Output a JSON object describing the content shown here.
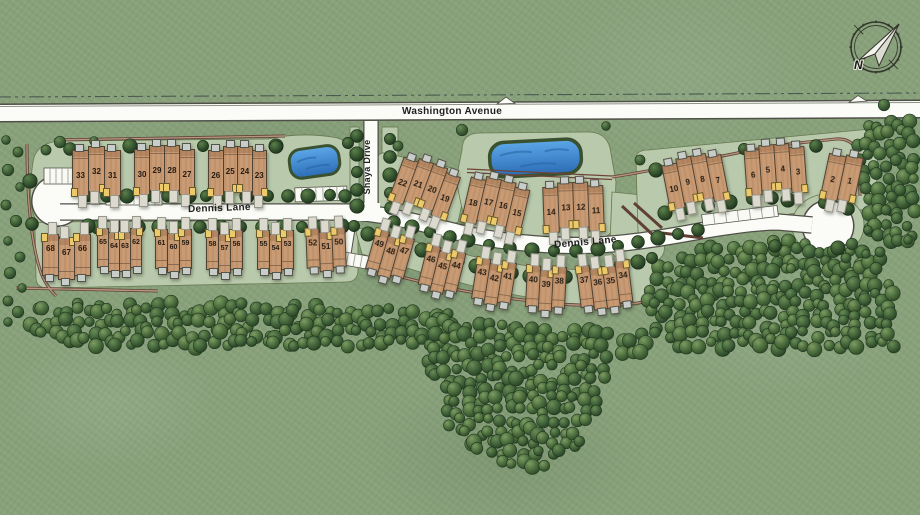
{
  "map": {
    "title": "community site plan",
    "streets": {
      "washington_avenue": "Washington Avenue",
      "dennis_lane_west": "Dennis Lane",
      "dennis_lane_east": "Dennis Lane",
      "shaya_drive": "Shaya Drive"
    },
    "compass": {
      "north_label": "N"
    },
    "colors": {
      "grass": "#8ba47e",
      "road": "#fbfcf7",
      "road_casing": "#4f5047",
      "pad": "#b9c9ab",
      "pad_border": "#66784f",
      "house": "#c89b75",
      "house_border": "#4e4232",
      "pond": "#3f87d2",
      "tree": "#3c5c33",
      "trail": "#6f4336",
      "porch": "#ecc96b",
      "deck": "#c9cdc9",
      "driveway": "#dcdacf",
      "lot_number_ink": "#241a10",
      "label_ink": "#1f1f1f"
    },
    "lot_groups": [
      {
        "lots": [
          "33",
          "32",
          "31"
        ],
        "row": "north",
        "x": 72,
        "y": 150,
        "uw": 17,
        "uh": 46,
        "rot": 0
      },
      {
        "lots": [
          "30",
          "29",
          "28",
          "27"
        ],
        "row": "north",
        "x": 134,
        "y": 149,
        "uw": 16,
        "uh": 46,
        "rot": 0
      },
      {
        "lots": [
          "26",
          "25",
          "24",
          "23"
        ],
        "row": "north",
        "x": 208,
        "y": 150,
        "uw": 15.5,
        "uh": 46,
        "rot": 0
      },
      {
        "lots": [
          "22",
          "21",
          "20",
          "19"
        ],
        "row": "north",
        "x": 394,
        "y": 166,
        "uw": 16,
        "uh": 46,
        "rot": 20
      },
      {
        "lots": [
          "18",
          "17",
          "16",
          "15"
        ],
        "row": "north",
        "x": 465,
        "y": 183,
        "uw": 16,
        "uh": 46,
        "rot": 13
      },
      {
        "lots": [
          "14",
          "13",
          "12",
          "11"
        ],
        "row": "north",
        "x": 543,
        "y": 186,
        "uw": 16,
        "uh": 46,
        "rot": -2
      },
      {
        "lots": [
          "10",
          "9",
          "8",
          "7"
        ],
        "row": "north",
        "x": 665,
        "y": 159,
        "uw": 16,
        "uh": 46,
        "rot": -11
      },
      {
        "lots": [
          "6",
          "5",
          "4",
          "3"
        ],
        "row": "north",
        "x": 745,
        "y": 148,
        "uw": 16,
        "uh": 46,
        "rot": -4
      },
      {
        "lots": [
          "2",
          "1"
        ],
        "row": "north",
        "x": 824,
        "y": 156,
        "uw": 18,
        "uh": 46,
        "rot": 12
      },
      {
        "lots": [
          "68",
          "67",
          "66"
        ],
        "row": "south",
        "x": 42,
        "y": 234,
        "uw": 17,
        "uh": 42,
        "rot": 0
      },
      {
        "lots": [
          "65",
          "64",
          "63",
          "62"
        ],
        "row": "south",
        "x": 97,
        "y": 228,
        "uw": 12,
        "uh": 40,
        "rot": 0
      },
      {
        "lots": [
          "61",
          "60",
          "59"
        ],
        "row": "south",
        "x": 155,
        "y": 229,
        "uw": 13,
        "uh": 40,
        "rot": 0
      },
      {
        "lots": [
          "58",
          "57",
          "56"
        ],
        "row": "south",
        "x": 206,
        "y": 230,
        "uw": 13,
        "uh": 40,
        "rot": 0
      },
      {
        "lots": [
          "55",
          "54",
          "53"
        ],
        "row": "south",
        "x": 257,
        "y": 230,
        "uw": 13,
        "uh": 40,
        "rot": 0
      },
      {
        "lots": [
          "52",
          "51",
          "50"
        ],
        "row": "south",
        "x": 306,
        "y": 228,
        "uw": 14,
        "uh": 40,
        "rot": -2
      },
      {
        "lots": [
          "49",
          "48",
          "47"
        ],
        "row": "south",
        "x": 370,
        "y": 233,
        "uw": 14,
        "uh": 42,
        "rot": 16
      },
      {
        "lots": [
          "46",
          "45",
          "44"
        ],
        "row": "south",
        "x": 422,
        "y": 248,
        "uw": 14,
        "uh": 42,
        "rot": 14
      },
      {
        "lots": [
          "43",
          "42",
          "41"
        ],
        "row": "south",
        "x": 474,
        "y": 260,
        "uw": 14,
        "uh": 42,
        "rot": 9
      },
      {
        "lots": [
          "40",
          "39",
          "38"
        ],
        "row": "south",
        "x": 526,
        "y": 266,
        "uw": 14,
        "uh": 42,
        "rot": 3
      },
      {
        "lots": [
          "37",
          "36",
          "35",
          "34"
        ],
        "row": "south",
        "x": 578,
        "y": 263,
        "uw": 14,
        "uh": 42,
        "rot": -7
      }
    ]
  }
}
